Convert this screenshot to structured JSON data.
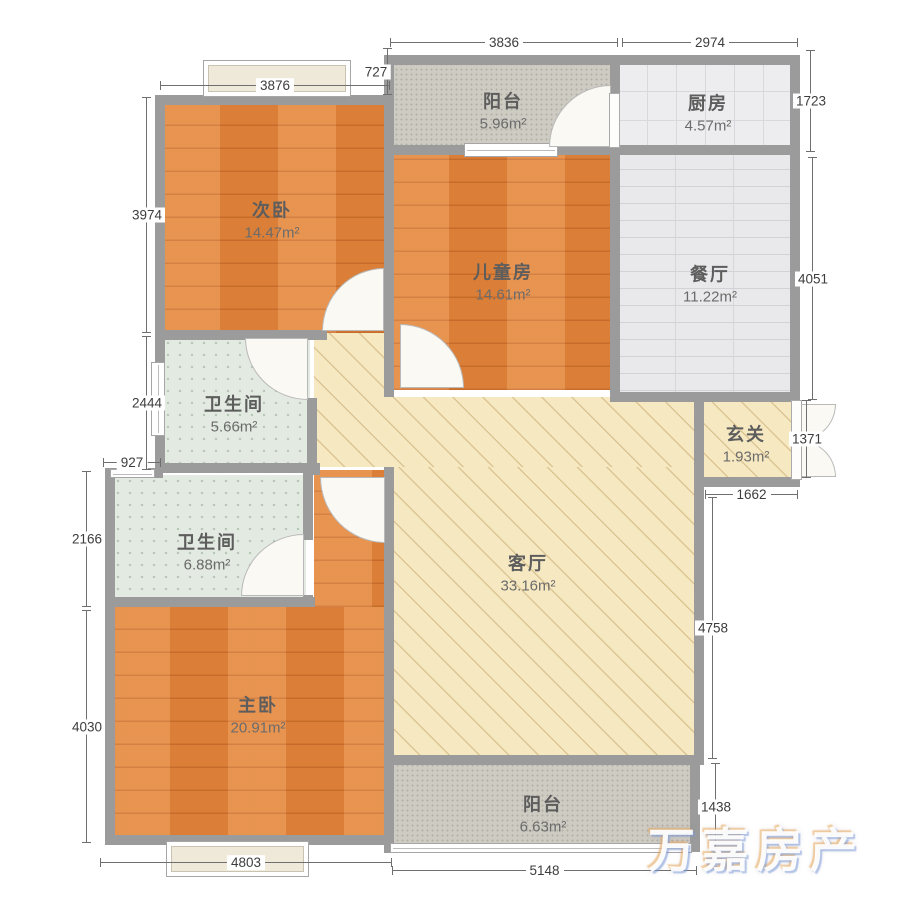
{
  "rooms": {
    "balcony_top": {
      "name": "阳台",
      "area": "5.96m²"
    },
    "kitchen": {
      "name": "厨房",
      "area": "4.57m²"
    },
    "bedroom2": {
      "name": "次卧",
      "area": "14.47m²"
    },
    "kids_room": {
      "name": "儿童房",
      "area": "14.61m²"
    },
    "dining": {
      "name": "餐厅",
      "area": "11.22m²"
    },
    "bath1": {
      "name": "卫生间",
      "area": "5.66m²"
    },
    "foyer": {
      "name": "玄关",
      "area": "1.93m²"
    },
    "bath2": {
      "name": "卫生间",
      "area": "6.88m²"
    },
    "living": {
      "name": "客厅",
      "area": "33.16m²"
    },
    "master": {
      "name": "主卧",
      "area": "20.91m²"
    },
    "balcony_bottom": {
      "name": "阳台",
      "area": "6.63m²"
    }
  },
  "dimensions": {
    "top_balcony": "3836",
    "top_kitchen": "2974",
    "bedroom2_width": "3876",
    "bedroom2_offset": "727",
    "bedroom2_height": "3974",
    "bath1_height": "2444",
    "bath2_offset": "927",
    "bath2_height": "2166",
    "master_height": "4030",
    "kitchen_height": "1723",
    "dining_height": "4051",
    "foyer_height": "1371",
    "foyer_width": "1662",
    "living_height": "4758",
    "balcony_bottom_height": "1438",
    "master_width": "4803",
    "balcony_bottom_width": "5148"
  },
  "watermark": {
    "text": "万嘉房产"
  },
  "colors": {
    "wall": "#9b9b9b",
    "wood_floor": "#e6883d",
    "living_floor": "#f6e9c2",
    "bath_tile": "#e3eae1",
    "kitchen_tile": "#ededef",
    "balcony_tile": "#cecbc3"
  }
}
